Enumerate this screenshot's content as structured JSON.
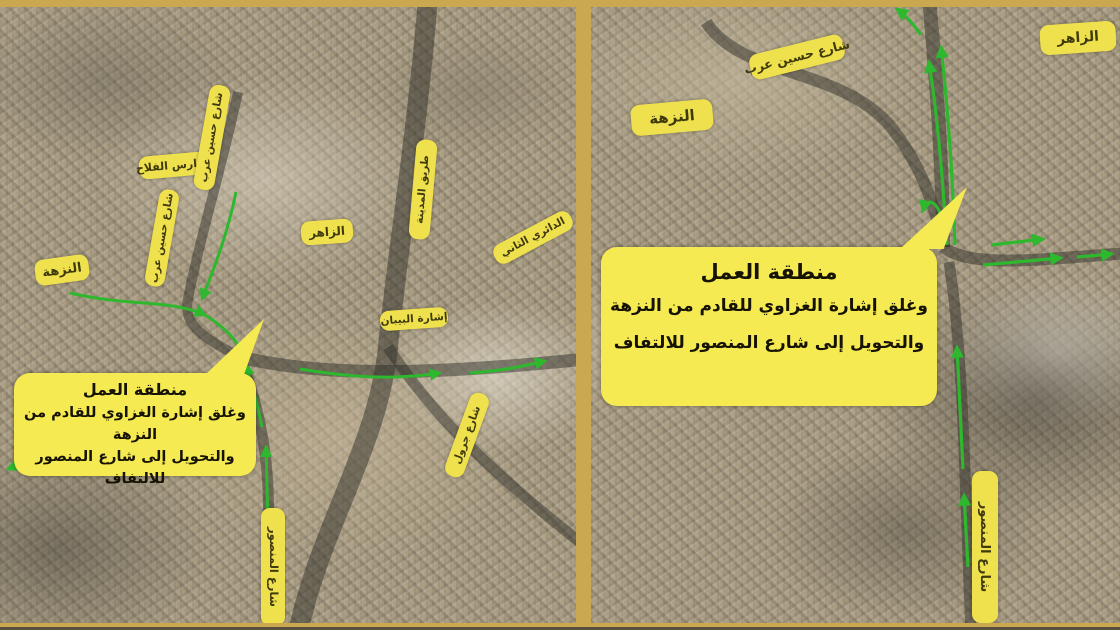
{
  "colors": {
    "frame": "#c9a850",
    "label_bg": "#efe04e",
    "label_text": "#3f3a0c",
    "callout_bg": "#f5ea51",
    "arrow_green": "#2eb82e",
    "road_dark": "rgba(48,48,42,0.5)"
  },
  "panels": {
    "left": {
      "labels": [
        {
          "id": "falah-schools-label",
          "text": "مدارس الفلاح",
          "cx": 173,
          "cy": 158,
          "w": 68,
          "h": 23,
          "rot": -5,
          "fs": 11
        },
        {
          "id": "hussein-arab-street-upper-label",
          "text": "شارع حسين عرب",
          "cx": 212,
          "cy": 130,
          "w": 106,
          "h": 21,
          "rot": -80,
          "fs": 10.5
        },
        {
          "id": "hussein-arab-street-label",
          "text": "شارع حسين عرب",
          "cx": 162,
          "cy": 231,
          "w": 98,
          "h": 20,
          "rot": -80,
          "fs": 10.5
        },
        {
          "id": "nuzha-district-label",
          "text": "النزهة",
          "cx": 62,
          "cy": 263,
          "w": 54,
          "h": 26,
          "rot": -8,
          "fs": 13
        },
        {
          "id": "zahir-district-label",
          "text": "الزاهر",
          "cx": 327,
          "cy": 225,
          "w": 52,
          "h": 24,
          "rot": -4,
          "fs": 12
        },
        {
          "id": "madinah-road-label",
          "text": "طريق المدينة",
          "cx": 423,
          "cy": 182,
          "w": 100,
          "h": 21,
          "rot": -85,
          "fs": 10.5
        },
        {
          "id": "second-ring-road-label",
          "text": "الدائري الثاني",
          "cx": 533,
          "cy": 230,
          "w": 86,
          "h": 21,
          "rot": -28,
          "fs": 10.5
        },
        {
          "id": "bibann-signal-label",
          "text": "إشارة البيبان",
          "cx": 414,
          "cy": 312,
          "w": 68,
          "h": 20,
          "rot": -4,
          "fs": 10.5
        },
        {
          "id": "jarwal-street-label",
          "text": "شارع جرول",
          "cx": 467,
          "cy": 428,
          "w": 88,
          "h": 20,
          "rot": -70,
          "fs": 10.5
        },
        {
          "id": "mansour-street-label",
          "text": "شارع المنصور",
          "cx": 273,
          "cy": 560,
          "w": 118,
          "h": 24,
          "rot": 90,
          "fs": 11.5
        }
      ],
      "callout": {
        "x": 14,
        "y": 366,
        "w": 242,
        "h": 98,
        "title": "منطقة العمل",
        "lines": [
          "وغلق إشارة الغزاوي للقادم من",
          "النزهة",
          "والتحويل إلى شارع المنصور للالتفاف"
        ]
      }
    },
    "right": {
      "labels": [
        {
          "id": "hussein-arab-street-label",
          "text": "شارع حسين عرب",
          "cx": 206,
          "cy": 50,
          "w": 96,
          "h": 26,
          "rot": -14,
          "fs": 12.5
        },
        {
          "id": "nuzha-district-label",
          "text": "النزهة",
          "cx": 81,
          "cy": 110,
          "w": 82,
          "h": 31,
          "rot": -5,
          "fs": 15
        },
        {
          "id": "zahir-district-label",
          "text": "الزاهر",
          "cx": 487,
          "cy": 31,
          "w": 76,
          "h": 30,
          "rot": -4,
          "fs": 14
        },
        {
          "id": "mansour-street-label",
          "text": "شارع المنصور",
          "cx": 394,
          "cy": 540,
          "w": 152,
          "h": 26,
          "rot": 90,
          "fs": 13
        }
      ],
      "callout": {
        "x": 10,
        "y": 240,
        "w": 336,
        "h": 150,
        "title": "منطقة العمل",
        "lines": [
          "وغلق إشارة الغزاوي للقادم من النزهة",
          "والتحويل إلى شارع المنصور للالتفاف"
        ]
      }
    }
  }
}
